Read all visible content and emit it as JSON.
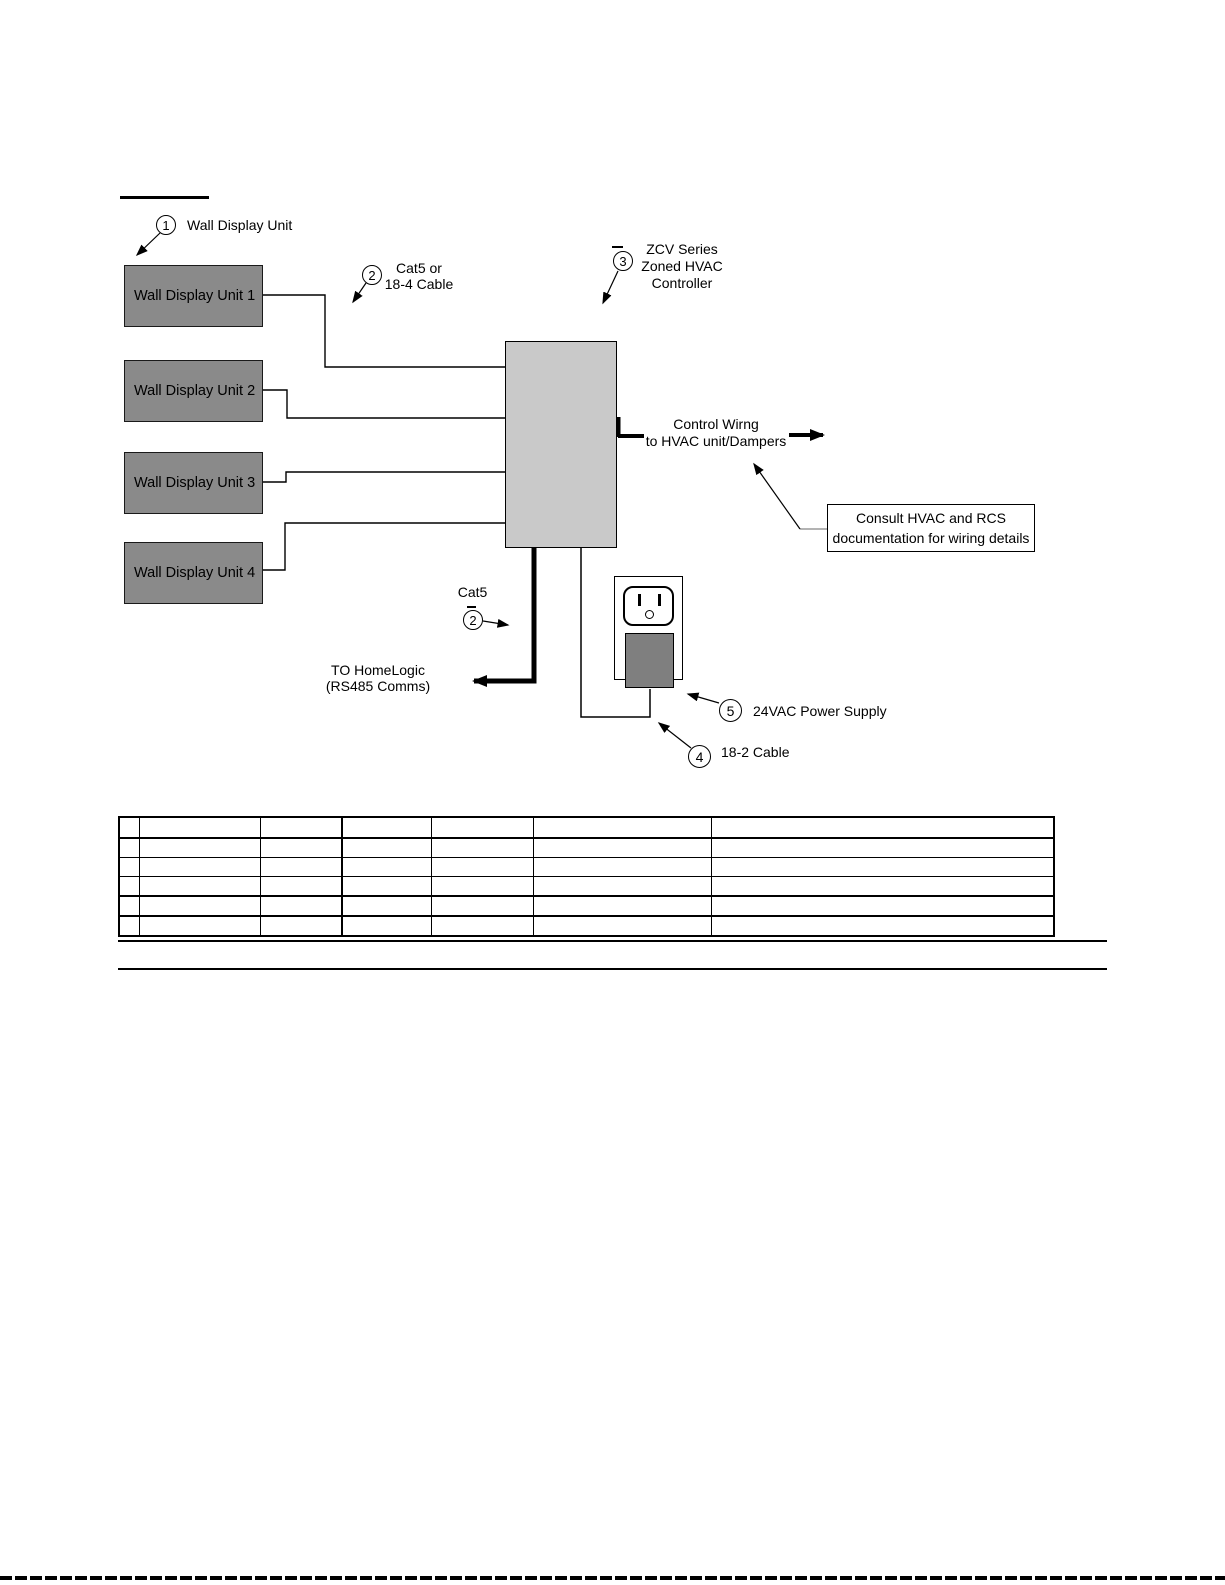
{
  "callouts": {
    "c1": {
      "number": "1",
      "label": "Wall Display Unit"
    },
    "c2_top": {
      "number": "2",
      "lines": [
        "Cat5 or",
        "18-4 Cable"
      ]
    },
    "c3": {
      "number": "3",
      "lines": [
        "ZCV Series",
        "Zoned HVAC",
        "Controller"
      ]
    },
    "c2_bottom": {
      "number": "2",
      "label": "Cat5"
    },
    "c4": {
      "number": "4",
      "label": "18-2 Cable"
    },
    "c5": {
      "number": "5",
      "label": "24VAC Power Supply"
    }
  },
  "units": [
    "Wall Display Unit 1",
    "Wall Display Unit 2",
    "Wall Display Unit 3",
    "Wall Display Unit 4"
  ],
  "labels": {
    "control_wiring": [
      "Control Wirng",
      "to HVAC unit/Dampers"
    ],
    "homelogic": [
      "TO HomeLogic",
      "(RS485 Comms)"
    ],
    "consult_note": [
      "Consult HVAC and RCS",
      "documentation for wiring details"
    ]
  },
  "colors": {
    "unit_box_fill": "#8a8a8a",
    "controller_fill": "#c9c9c9",
    "plug_fill": "#7f7f7f",
    "line": "#000000",
    "page_bg": "#ffffff"
  },
  "table": {
    "rows": 6,
    "columns": 7,
    "cells": [
      [
        "",
        "",
        "",
        "",
        "",
        "",
        ""
      ],
      [
        "",
        "",
        "",
        "",
        "",
        "",
        ""
      ],
      [
        "",
        "",
        "",
        "",
        "",
        "",
        ""
      ],
      [
        "",
        "",
        "",
        "",
        "",
        "",
        ""
      ],
      [
        "",
        "",
        "",
        "",
        "",
        "",
        ""
      ],
      [
        "",
        "",
        "",
        "",
        "",
        "",
        ""
      ]
    ]
  }
}
